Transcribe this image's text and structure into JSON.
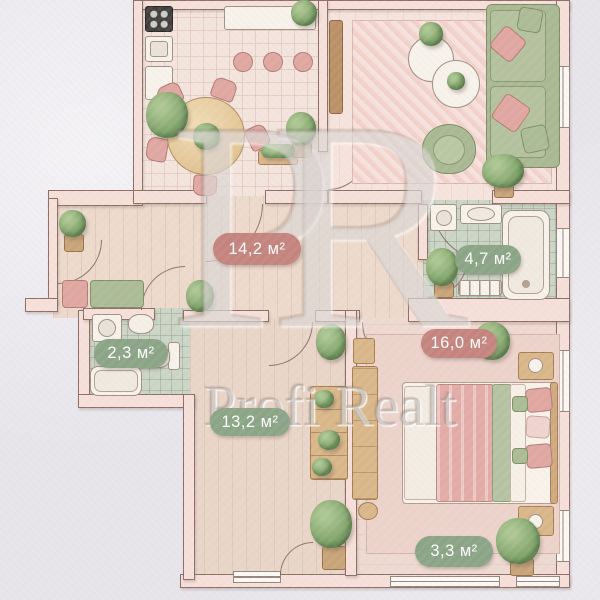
{
  "labels": {
    "hall": {
      "text": "14,2 м²",
      "color": "#c4837d"
    },
    "bathroom": {
      "text": "4,7 м²",
      "color": "#8aa485"
    },
    "wc": {
      "text": "2,3 м²",
      "color": "#8aa485"
    },
    "bedroom": {
      "text": "16,0 м²",
      "color": "#c4837d"
    },
    "corridor": {
      "text": "13,2 м²",
      "color": "#8aa485"
    },
    "balcony": {
      "text": "3,3 м²",
      "color": "#8aa485"
    }
  },
  "watermark": {
    "monogram": "PR",
    "brand": "Profi Realt"
  },
  "palette": {
    "background": "#e7e4ea",
    "wall_fill": "#f6dfd8",
    "wall_line": "#8a6e64",
    "sofa_green": "#a9b893",
    "pillow_pink": "#e0a6a0",
    "wood": "#d9b688"
  }
}
